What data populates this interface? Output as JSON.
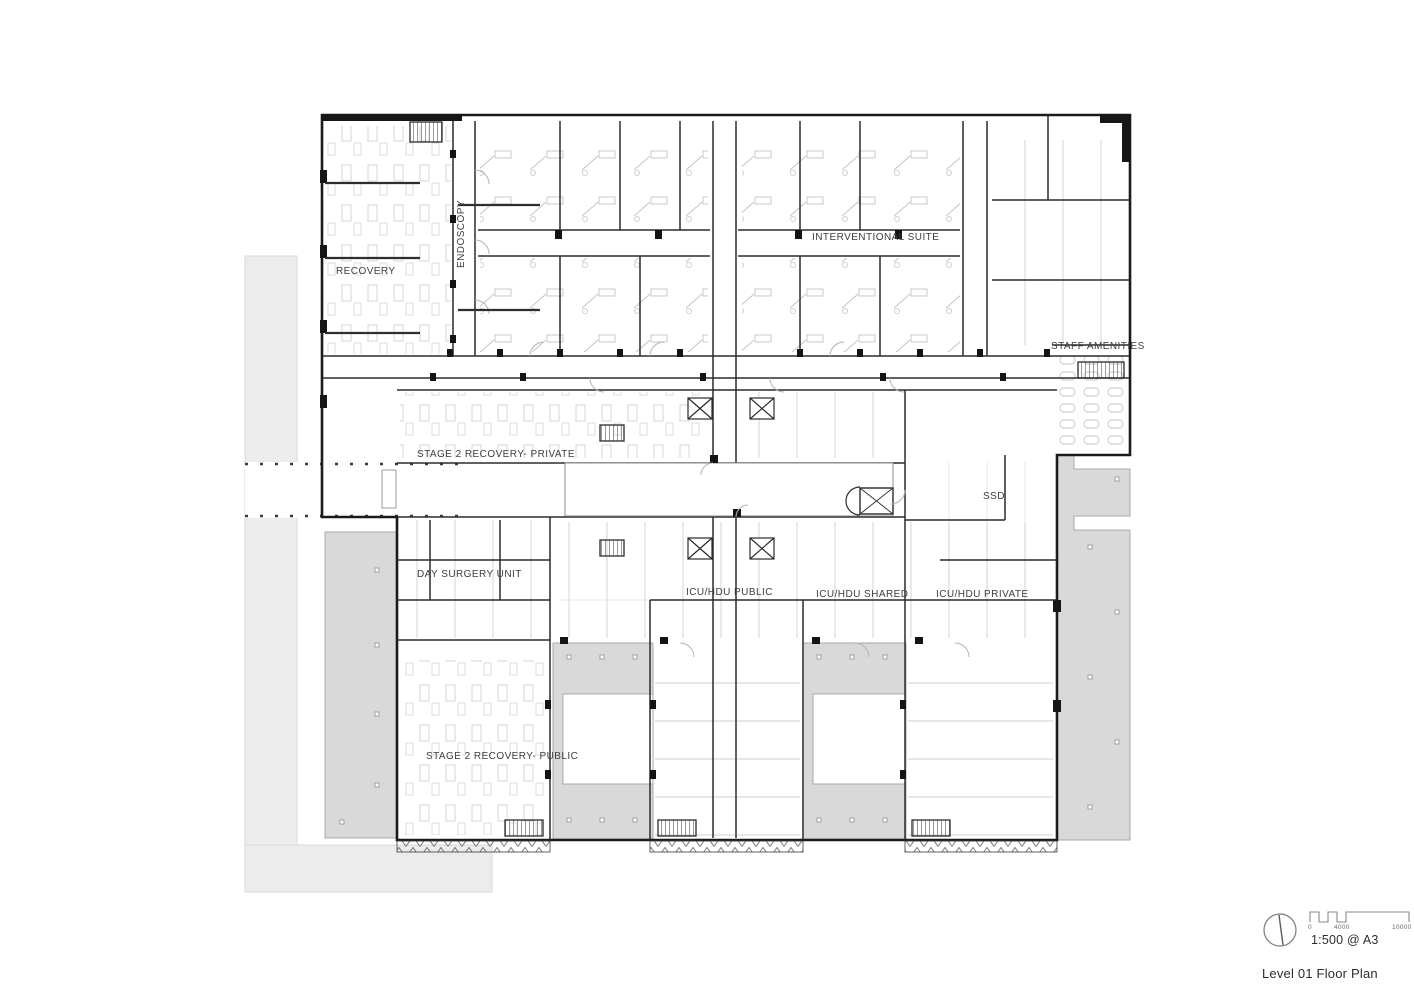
{
  "drawing": {
    "labels": {
      "recovery": "RECOVERY",
      "endoscopy": "ENDOSCOPY",
      "interventional_suite": "INTERVENTIONAL SUITE",
      "staff_amenities": "STAFF AMENITIES",
      "stage2_private": "STAGE 2 RECOVERY- PRIVATE",
      "ssd": "SSD",
      "day_surgery": "DAY SURGERY UNIT",
      "icu_public": "ICU/HDU PUBLIC",
      "icu_shared": "ICU/HDU SHARED",
      "icu_private": "ICU/HDU PRIVATE",
      "stage2_public": "STAGE 2 RECOVERY- PUBLIC"
    },
    "title_block": {
      "scale_text": "1:500 @ A3",
      "drawing_title": "Level 01 Floor Plan",
      "scale_ticks": [
        "0",
        "4000",
        "10000"
      ]
    },
    "colors": {
      "wall": "#1b1b1b",
      "partition": "#2e2e2e",
      "furniture_line": "#c7c7c7",
      "site_light_gray": "#ececec",
      "terrace_gray": "#d9d9d9",
      "label_text": "#3d3d3d"
    }
  }
}
